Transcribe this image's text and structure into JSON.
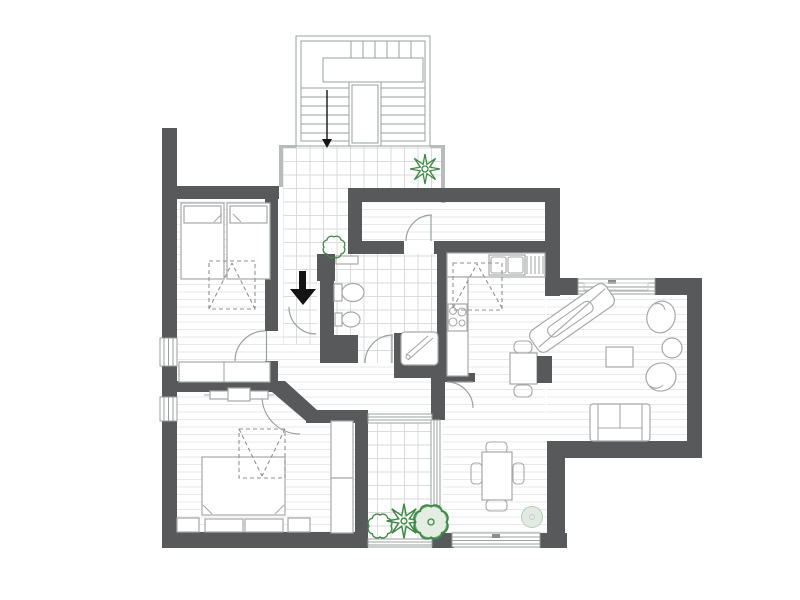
{
  "colors": {
    "wall": "#58595b",
    "thinwall": "#b7bcba",
    "outline": "#9aa09f",
    "furniture": "#a6a9a8",
    "furnitureLight": "#c9cccb",
    "door": "#9aa09f",
    "dash": "#8f9292",
    "floorLine": "#e8e8e8",
    "tileLine": "#d9dedc",
    "plant": "#3f8a45",
    "plantSoft": "#7fae85",
    "plantFill": "#e4ede2",
    "poufFill": "#e2ebe1",
    "poufStroke": "#b8cbb6",
    "arrow": "#141414"
  },
  "drawing": {
    "type": "apartment-floor-plan",
    "entrance_arrow_direction": "down",
    "stairs_arrow_direction": "down",
    "rooms": [
      {
        "name": "staircase",
        "items": [
          "u-shaped-stairs",
          "direction-arrow"
        ]
      },
      {
        "name": "entry-terrace",
        "items": [
          "tiled-floor",
          "plant",
          "plant"
        ]
      },
      {
        "name": "bedroom-1",
        "items": [
          "single-bed",
          "single-bed",
          "dashed-wardrobe",
          "dresser",
          "window",
          "window"
        ]
      },
      {
        "name": "bedroom-2",
        "items": [
          "double-bed",
          "nightstand",
          "nightstand",
          "dashed-wardrobe",
          "built-in-wardrobe",
          "radiator",
          "window"
        ]
      },
      {
        "name": "hallway",
        "items": [
          "entrance-door",
          "interior-doors"
        ]
      },
      {
        "name": "bathroom",
        "items": [
          "toilet",
          "bidet",
          "shower",
          "radiator",
          "tiled-floor"
        ]
      },
      {
        "name": "utility-room",
        "items": [
          "door"
        ]
      },
      {
        "name": "kitchen",
        "items": [
          "counter",
          "sink",
          "cooktop",
          "dashed-cabinet",
          "small-table",
          "chairs"
        ]
      },
      {
        "name": "living-room",
        "items": [
          "sofa",
          "armchair",
          "armchair",
          "round-side-table",
          "coffee-table",
          "angled-console",
          "radiator",
          "window"
        ]
      },
      {
        "name": "dining-area",
        "items": [
          "dining-table",
          "four-chairs",
          "pouf",
          "window"
        ]
      },
      {
        "name": "loggia",
        "items": [
          "plants",
          "glazing",
          "tiled-floor"
        ]
      }
    ]
  }
}
